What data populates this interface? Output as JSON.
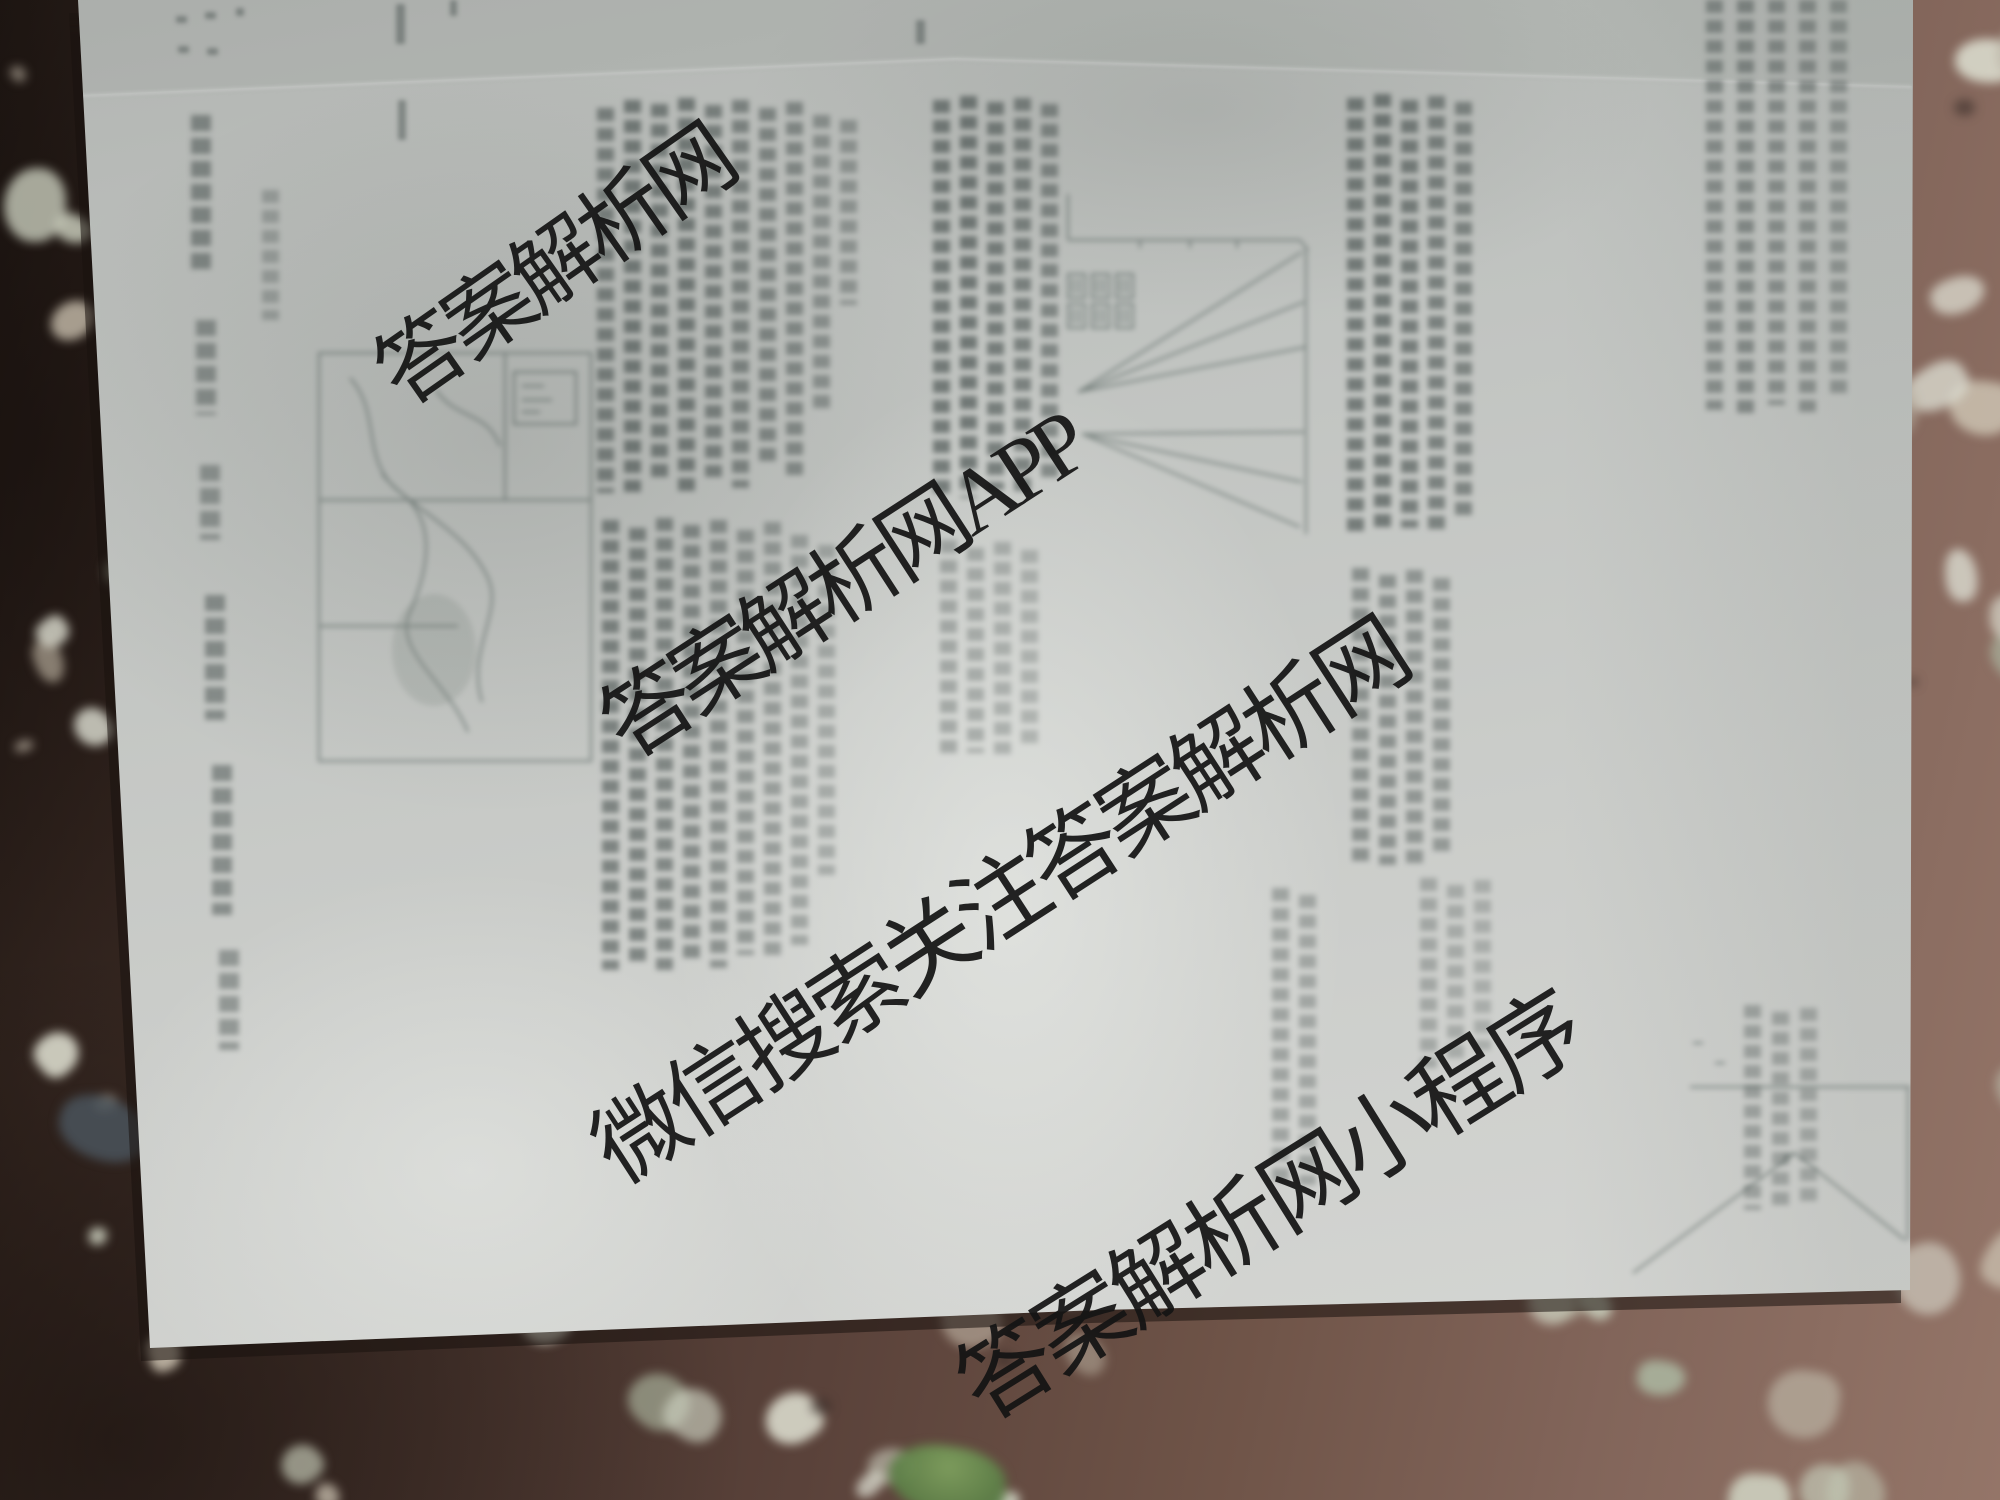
{
  "watermarks": {
    "site_name": "答案解析网",
    "app": "答案解析网APP",
    "wechat": "微信搜索关注答案解析网",
    "miniprogram": "答案解析网小程序"
  },
  "colors": {
    "watermark_ink": "#141414",
    "paper_base": "#c7c9c6",
    "paper_highlight": "#e2e3df",
    "floor_dark_brown": "#3a2c27",
    "floor_light_brown": "#8d7164",
    "terrazzo_chip_light": "#ccd0bf",
    "plant_green": "#5f8a4a"
  }
}
